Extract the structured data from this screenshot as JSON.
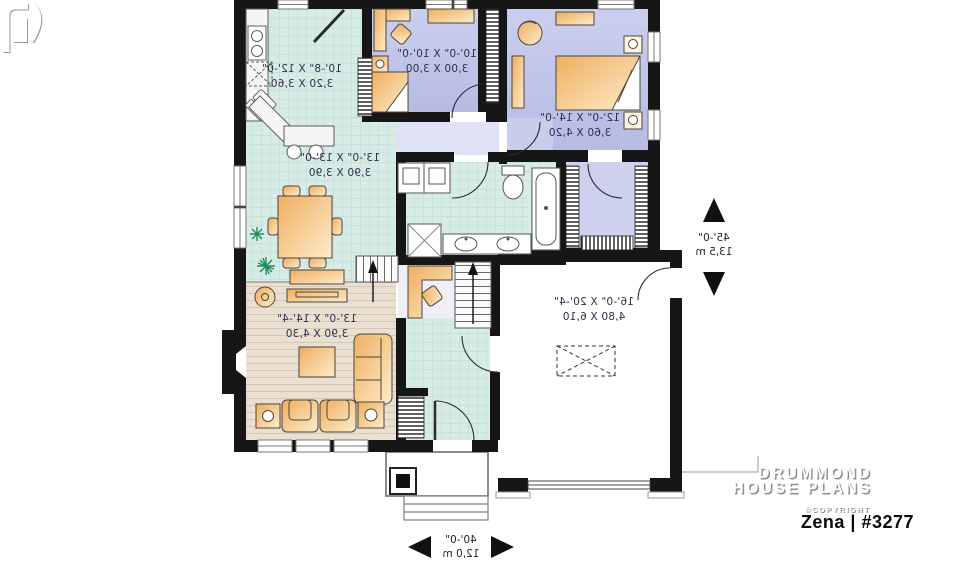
{
  "plan": {
    "title": "Zena | #3277",
    "brand": {
      "line1": "DRUMMOND",
      "line2": "HOUSE PLANS",
      "copyright": "©COPYRIGHT"
    },
    "rooms": {
      "kitchen": {
        "imperial": "10'-8\" X 12'-0\"",
        "metric": "3,20 X 3,60"
      },
      "dining": {
        "imperial": "13'-0\" X 13'-0\"",
        "metric": "3,90 X 3,90"
      },
      "living": {
        "imperial": "13'-0\" X 14'-4\"",
        "metric": "3,90 X 4,30"
      },
      "bedroom": {
        "imperial": "10'-0\" X 10'-0\"",
        "metric": "3,00 X 3,00"
      },
      "master_bedroom": {
        "imperial": "12'-0\" X 14'-0\"",
        "metric": "3,60 X 4,20"
      },
      "garage": {
        "imperial": "16'-0\" X 20'-4\"",
        "metric": "4,80 X 6,10"
      }
    },
    "overall": {
      "depth": {
        "imperial": "45'-0\"",
        "metric": "13,5 m"
      },
      "width": {
        "imperial": "40'-0\"",
        "metric": "12,0 m"
      }
    },
    "colors": {
      "wall": "#161616",
      "tile_floor": "#d8ece7",
      "tile_line": "#bed9d2",
      "bedroom_floor": "#c4c9ea",
      "living_floor": "#e9e0d2",
      "furniture": "#f3bb72",
      "plant": "#1f8e5a",
      "label_text": "#30304a"
    },
    "notes": {
      "text_rendering": "plan text appears mirrored in source image"
    }
  }
}
